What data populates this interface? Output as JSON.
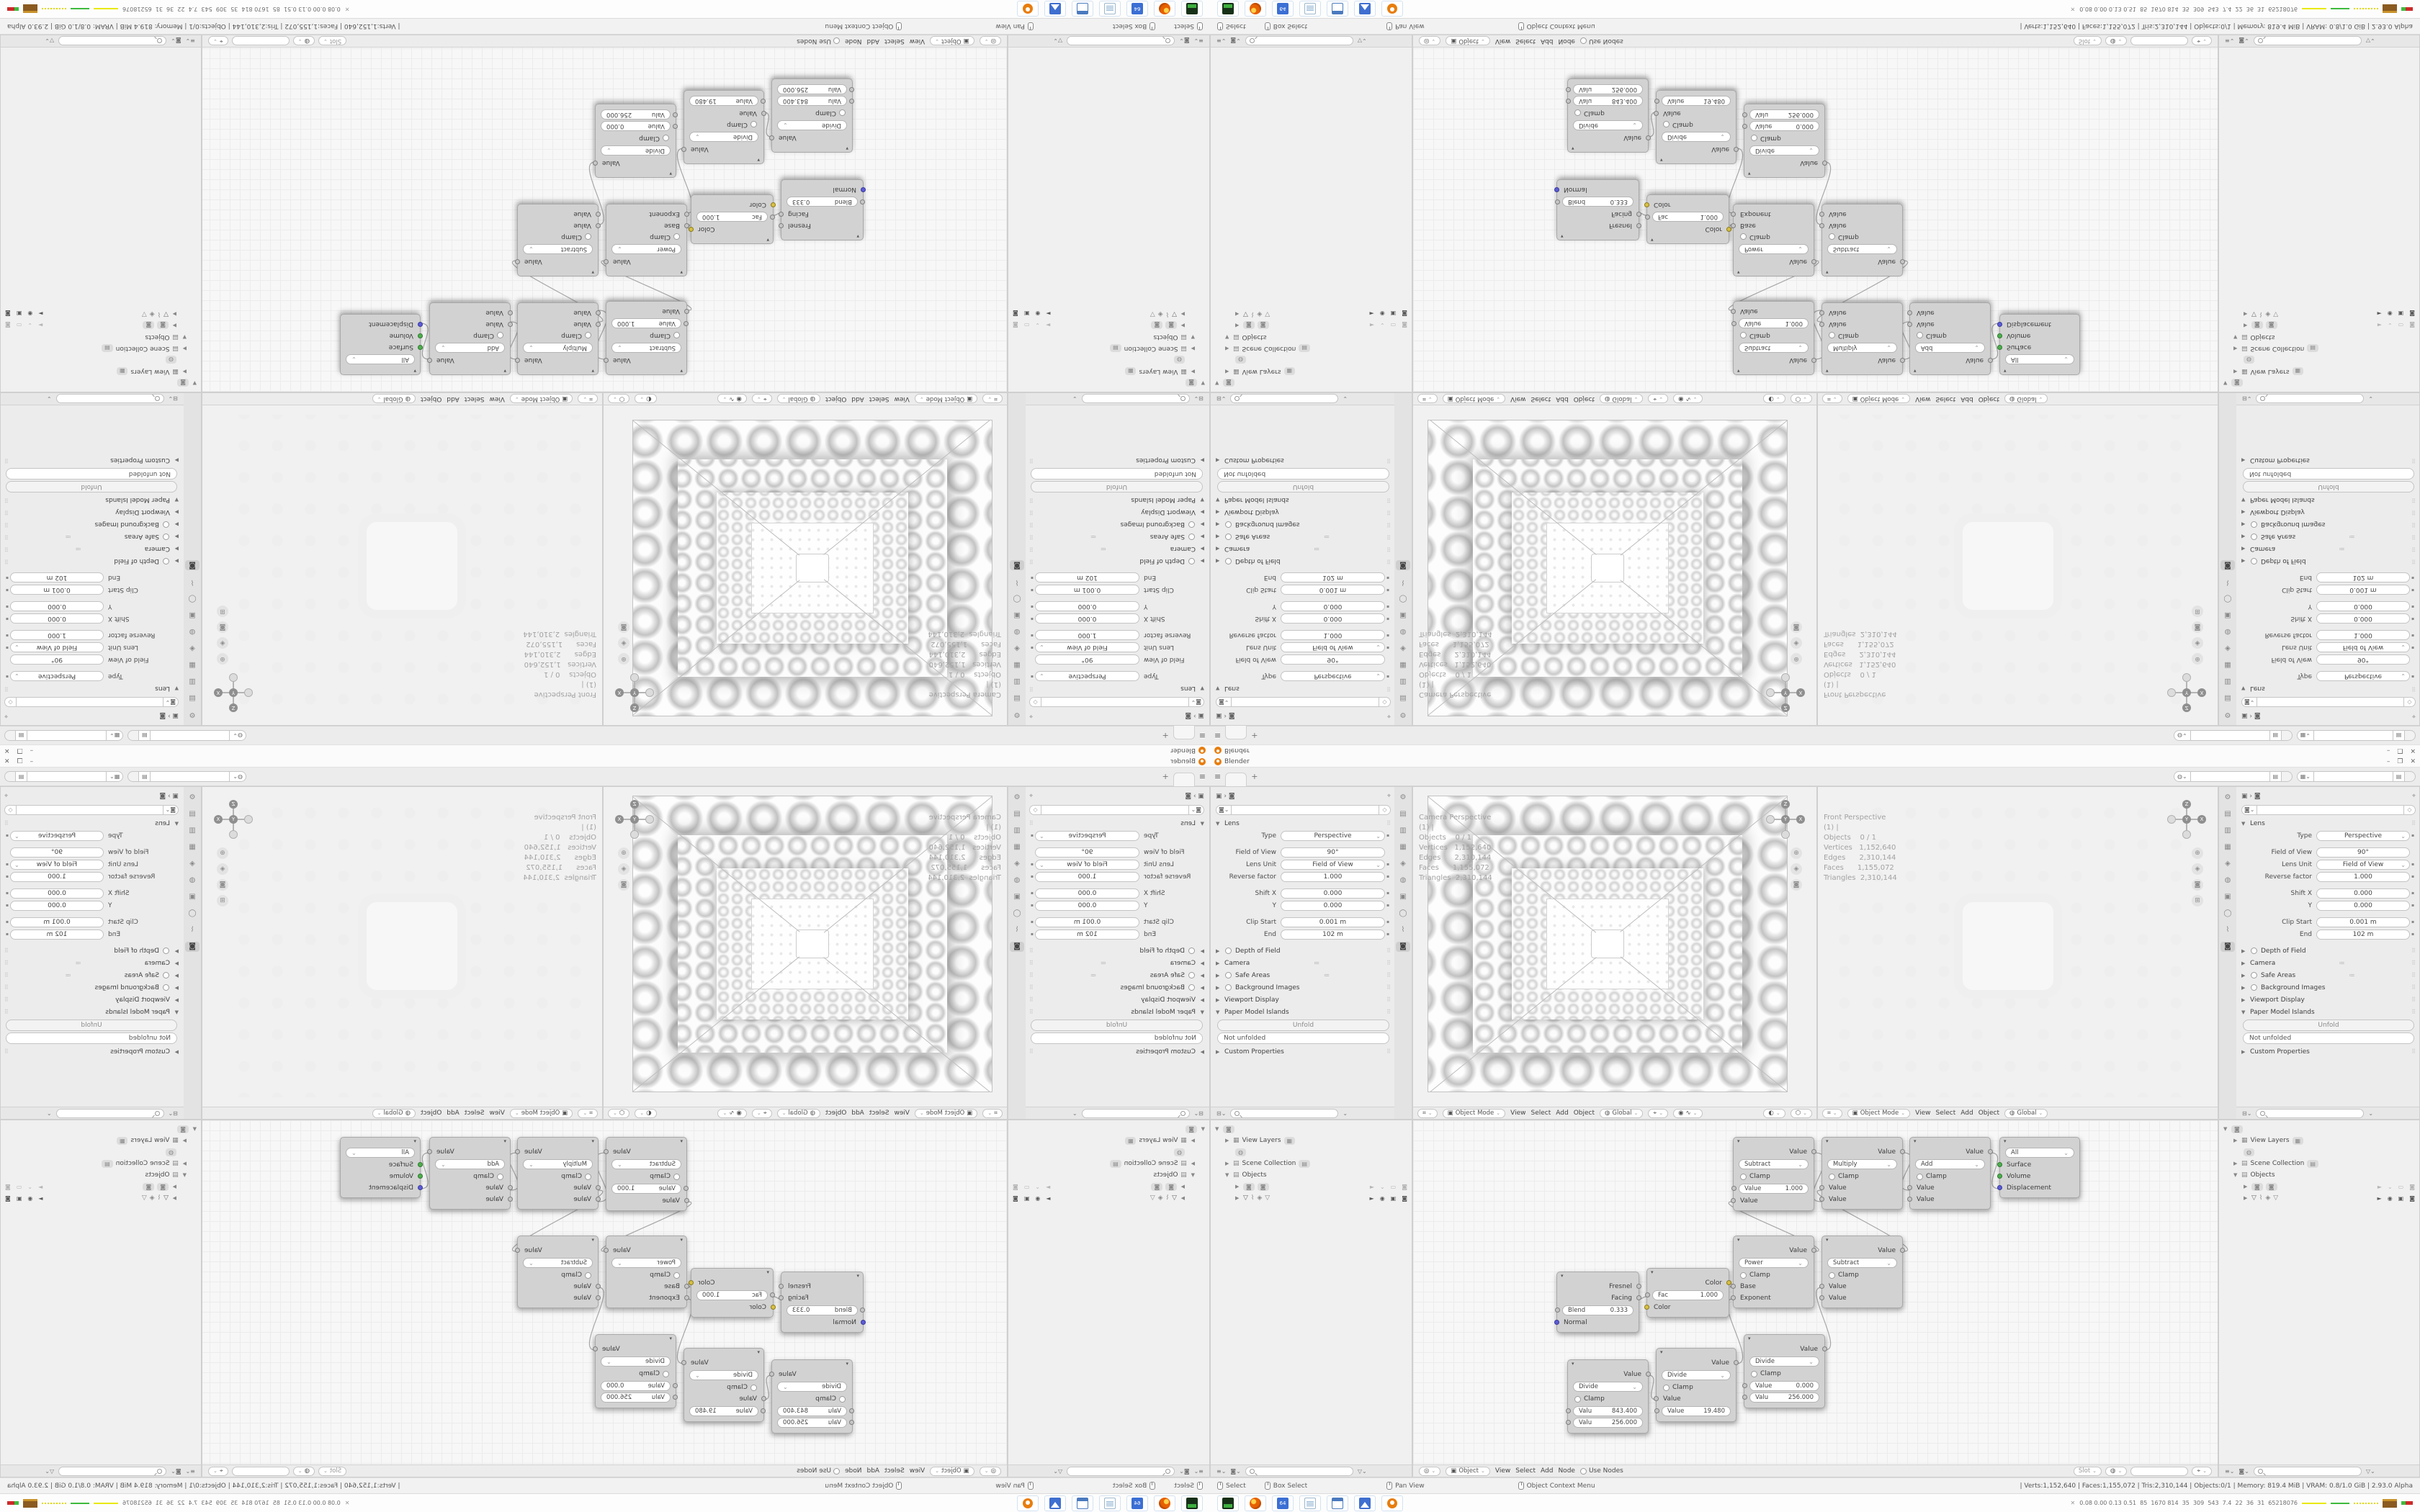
{
  "app": {
    "title": "Blender"
  },
  "titlebar": {
    "min": "–",
    "max": "❐",
    "close": "✕"
  },
  "topbar": {
    "new_tab": "+"
  },
  "properties": {
    "lens": {
      "title": "Lens",
      "type_label": "Type",
      "type_value": "Perspective",
      "fov_label": "Field of View",
      "fov_value": "90°",
      "unit_label": "Lens Unit",
      "unit_value": "Field of View",
      "reverse_label": "Reverse factor",
      "reverse_value": "1.000",
      "shiftx_label": "Shift X",
      "shiftx_value": "0.000",
      "shifty_label": "Y",
      "shifty_value": "0.000",
      "clip_label": "Clip Start",
      "clip_value": "0.001 m",
      "end_label": "End",
      "end_value": "102 m"
    },
    "dof": "Depth of Field",
    "camera": "Camera",
    "safe_areas": "Safe Areas",
    "bg_images": "Background Images",
    "viewport_display": "Viewport Display",
    "paper_title": "Paper Model Islands",
    "unfold": "Unfold",
    "unfold_status": "Not unfolded",
    "custom": "Custom Properties"
  },
  "viewport": {
    "mode": "Object Mode",
    "menu_view": "View",
    "menu_select": "Select",
    "menu_add": "Add",
    "menu_object": "Object",
    "orientation": "Global",
    "axis_x": "X",
    "axis_y": "Y",
    "axis_z": "Z",
    "overlay_cam": [
      "Camera Perspective",
      "(1) |",
      "",
      "Objects    0 / 1",
      "Vertices   1,152,640",
      "Edges      2,310,144",
      "Faces      1,155,072",
      "Triangles  2,310,144"
    ],
    "overlay_front": [
      "Front Perspective",
      "(1) |",
      "",
      "Objects    0 / 1",
      "Vertices   1,152,640",
      "Edges      2,310,144",
      "Faces      1,155,072",
      "Triangles  2,310,144"
    ]
  },
  "outliner": {
    "view_layers": "View Layers",
    "scene_collection": "Scene Collection",
    "objects": "Objects"
  },
  "shader": {
    "header": {
      "type": "Object",
      "menu_view": "View",
      "menu_select": "Select",
      "menu_add": "Add",
      "menu_node": "Node",
      "use_nodes": "Use Nodes",
      "slot": "Slot"
    },
    "clamp": "Clamp",
    "nodes": {
      "lw": {
        "out1": "Fresnel",
        "out2": "Facing",
        "f1l": "Blend",
        "f1v": "0.333",
        "in1": "Normal"
      },
      "inv": {
        "out1": "Color",
        "f1l": "Fac",
        "f1v": "1.000",
        "in1": "Color"
      },
      "d1": {
        "op": "Divide",
        "out": "Value",
        "f1l": "Valu",
        "f1v": "843.400",
        "f2l": "Valu",
        "f2v": "256.000"
      },
      "d2": {
        "op": "Divide",
        "out": "Value",
        "in1": "Value",
        "f1l": "Value",
        "f1v": "19.480"
      },
      "d3": {
        "op": "Divide",
        "out": "Value",
        "f1l": "Value",
        "f1v": "0.000",
        "f2l": "Valu",
        "f2v": "256.000"
      },
      "pw": {
        "op": "Power",
        "out": "Value",
        "in1": "Base",
        "in2": "Exponent"
      },
      "s1": {
        "op": "Subtract",
        "out": "Value",
        "f1l": "Value",
        "f1v": "1.000",
        "in1": "Value"
      },
      "s2": {
        "op": "Subtract",
        "out": "Value",
        "in1": "Value",
        "in2": "Value"
      },
      "mu": {
        "op": "Multiply",
        "out": "Value",
        "in1": "Value",
        "in2": "Value"
      },
      "ad": {
        "op": "Add",
        "out": "Value",
        "in1": "Value",
        "in2": "Value"
      },
      "out": {
        "target": "All",
        "in1": "Surface",
        "in2": "Volume",
        "in3": "Displacement"
      }
    }
  },
  "statusbar": {
    "select": "Select",
    "box_select": "Box Select",
    "pan": "Pan View",
    "context": "Object Context Menu",
    "stats": "| Verts:1,152,640 | Faces:1,155,072 | Tris:2,310,144 | Objects:0/1 | Memory: 819.4 MiB | VRAM: 0.8/1.0 GiB | 2.93.0 Alpha"
  },
  "taskbar": {
    "floppy_label": "64",
    "tray_close": "✕",
    "tray_numbers": "0.08 0.00 0.13 0.51  85  1670 814  35  309  543  7.4  22  36  31  65218076"
  }
}
